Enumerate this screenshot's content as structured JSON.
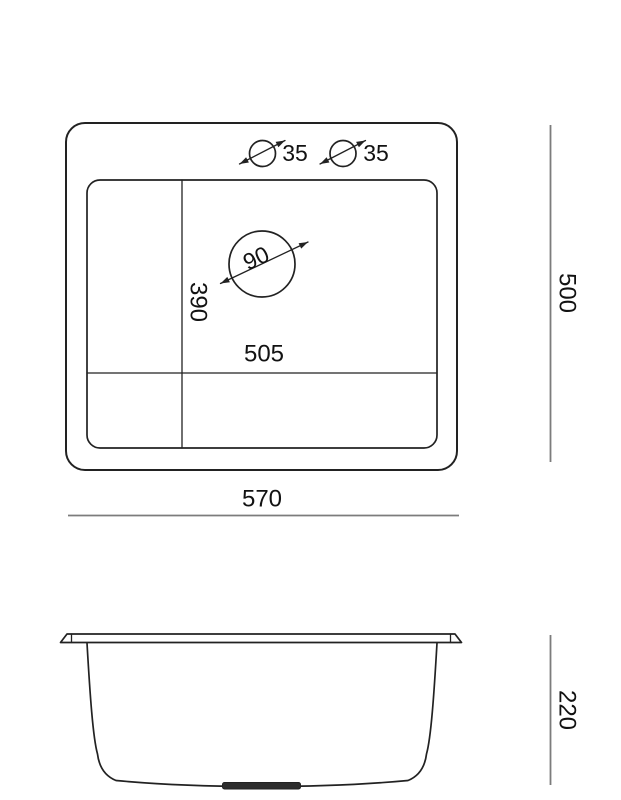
{
  "colors": {
    "outline": "#222222",
    "dimension_line": "#7c7c7c",
    "label_text": "#121212",
    "background": "#ffffff",
    "drain_plug_fill": "#2d2d2d"
  },
  "top_view": {
    "faucet_holes": [
      {
        "diameter_label": "35"
      },
      {
        "diameter_label": "35"
      }
    ],
    "drain_diameter_label": "90",
    "bowl_depth_label": "390",
    "bowl_width_label": "505",
    "overall_width_label": "570",
    "overall_depth_label": "500"
  },
  "side_view": {
    "overall_height_label": "220"
  }
}
